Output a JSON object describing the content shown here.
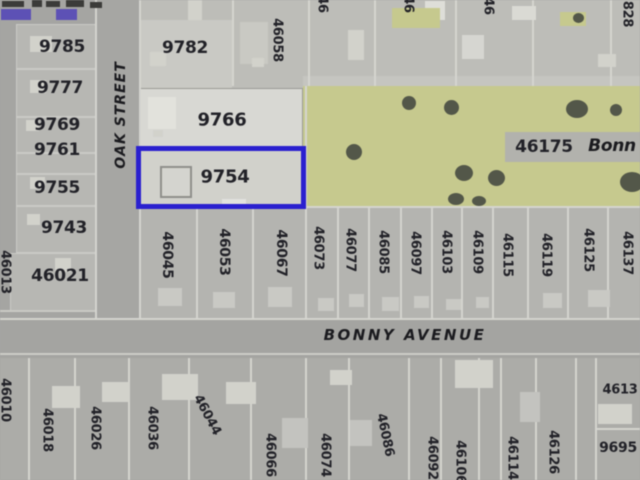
{
  "streets": {
    "oak": "OAK STREET",
    "bonny": "BONNY AVENUE"
  },
  "selected_parcel": "9754",
  "west_edge_lots": [
    "46013",
    "46010"
  ],
  "west_lots": [
    "9785",
    "9777",
    "9769",
    "9761",
    "9755",
    "9743",
    "46021"
  ],
  "top_lots": {
    "block_a": "9782",
    "block_b": "46058",
    "edge_partials": [
      "46",
      "46",
      "46"
    ],
    "corner_partial": "828"
  },
  "center_lots": {
    "upper": "9766",
    "selected": "9754"
  },
  "green_area": {
    "number": "46175",
    "street_text": "Bonn"
  },
  "bonny_north_lots": [
    "46045",
    "46053",
    "46067",
    "46073",
    "46077",
    "46085",
    "46097",
    "46103",
    "46109",
    "46115",
    "46119",
    "46125",
    "46137"
  ],
  "bonny_south_lots": [
    "46018",
    "46026",
    "46036",
    "46044",
    "46066",
    "46074",
    "46086",
    "46092",
    "46106",
    "46114",
    "46126"
  ],
  "south_right_lots": {
    "upper": "4613",
    "lower": "9695"
  },
  "colors": {
    "highlight": "#2c22cd",
    "green_area": "#c5c88e",
    "road": "#a3a3a0",
    "parcel_light": "#d6d6d1",
    "background": "#a6a6a3",
    "text": "#24242a",
    "accent_purple": "#5e52b4"
  }
}
